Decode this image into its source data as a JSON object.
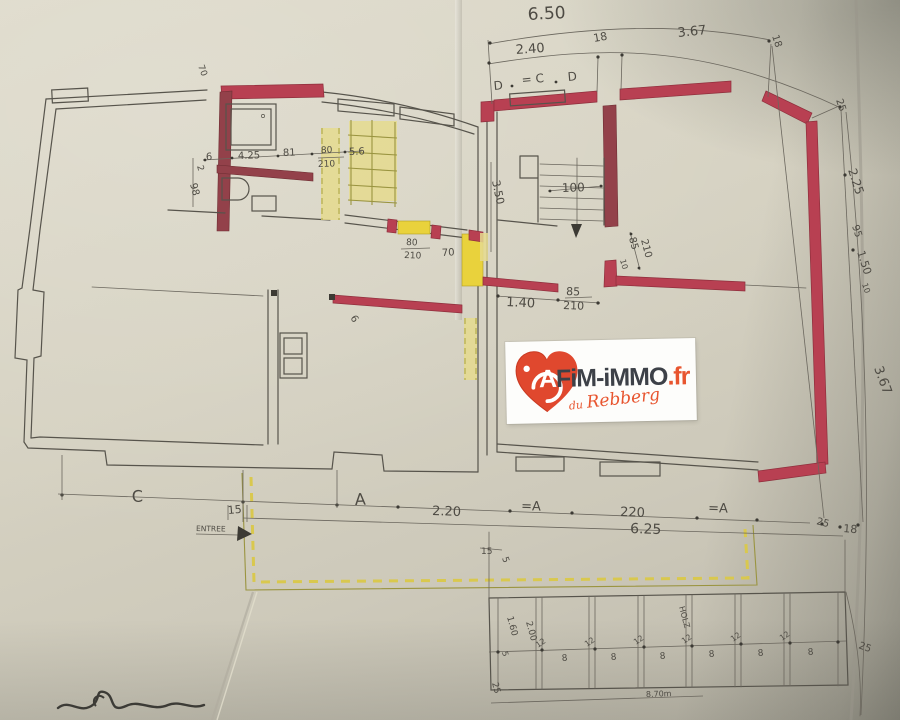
{
  "watermark": {
    "brand_a": "A",
    "brand_main": "FiM-iMMO",
    "brand_tld": ".fr",
    "tagline_du": "du",
    "tagline_name": "Rebberg"
  },
  "palette": {
    "paper": "#d6d2c2",
    "pencil": "#57544c",
    "red_wall": "#b84052",
    "dark_red_wall": "#93414a",
    "yellow_highlight": "#e9d23c",
    "olive_hatch": "#9a9440",
    "logo_orange": "#e8552f",
    "logo_text": "#3d4148"
  },
  "labels": {
    "top": {
      "overall": "6.50",
      "seg1": "2.40",
      "tick1": "18",
      "seg2": "3.67",
      "tick2": "18",
      "tick3": "25"
    },
    "top_doors": {
      "left": "D",
      "center": "= C",
      "right": "D"
    },
    "bath": {
      "d1": "6",
      "d2": "4.25",
      "d3": "81",
      "door_w": "80",
      "door_h": "210",
      "d4": "5.6",
      "v1": "2",
      "v2": "98",
      "v3": "70"
    },
    "hall": {
      "door_w": "80",
      "door_h": "210",
      "d1": "70",
      "d2": "6"
    },
    "mid": {
      "d140": "1.40",
      "door_w": "85",
      "door_h": "210",
      "vdoor_w": "85",
      "vdoor_h": "210",
      "v10": "10",
      "stair": "100",
      "v350": "3.50"
    },
    "right": {
      "r1": "2.25",
      "r2": "95",
      "r3": "1.50",
      "r4": "10",
      "r5": "3.67",
      "r6": "25",
      "r7": "18"
    },
    "bottom": {
      "c": "C",
      "t15": "15",
      "entry": "ENTREE",
      "a1": "A",
      "d220a": "2.20",
      "a2": "=A",
      "d220b": "220",
      "a3": "=A",
      "total": "6.25",
      "s15": "15",
      "s5": "5"
    },
    "garage": {
      "left25": "25",
      "g160": "1.60",
      "g5": "5",
      "g200": "2.00",
      "g12": "12",
      "g8": "8",
      "holz": "HOLZ",
      "right25": "25",
      "total": "8.70m"
    }
  }
}
